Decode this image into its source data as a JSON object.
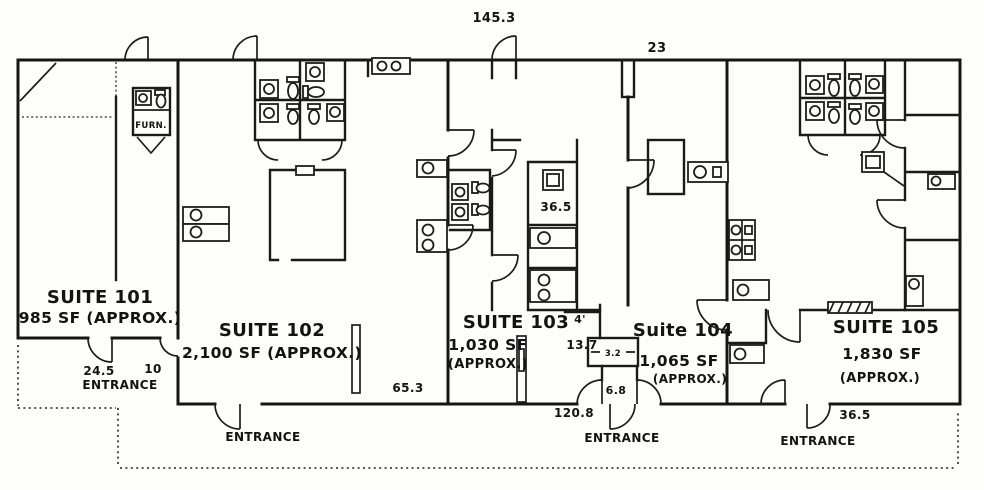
{
  "colors": {
    "ink": "#161616",
    "paper": "#fdfdfb"
  },
  "suites": [
    {
      "name": "SUITE 101",
      "area": "985 SF (APPROX.)",
      "approx": ""
    },
    {
      "name": "SUITE 102",
      "area": "2,100 SF (APPROX.)",
      "approx": ""
    },
    {
      "name": "SUITE 103",
      "area": "1,030 SF",
      "approx": "(APPROX.)"
    },
    {
      "name": "Suite 104",
      "area": "1,065 SF",
      "approx": "(APPROX.)"
    },
    {
      "name": "SUITE 105",
      "area": "1,830 SF",
      "approx": "(APPROX.)"
    }
  ],
  "dimensions": {
    "building_width_top": "145.3",
    "suite_104_width": "23",
    "restroom_room_width": "36.5",
    "entry_101_left": "24.5",
    "entry_101_right": "10",
    "suite_102_rear": "65.3",
    "nook_width": "4'",
    "nook_depth": "13.7",
    "closet_width": "3.2",
    "vestibule_width": "6.8",
    "frontage_mid": "120.8",
    "frontage_right": "36.5"
  },
  "labels": {
    "entrance": "ENTRANCE",
    "furnace": "FURN."
  }
}
